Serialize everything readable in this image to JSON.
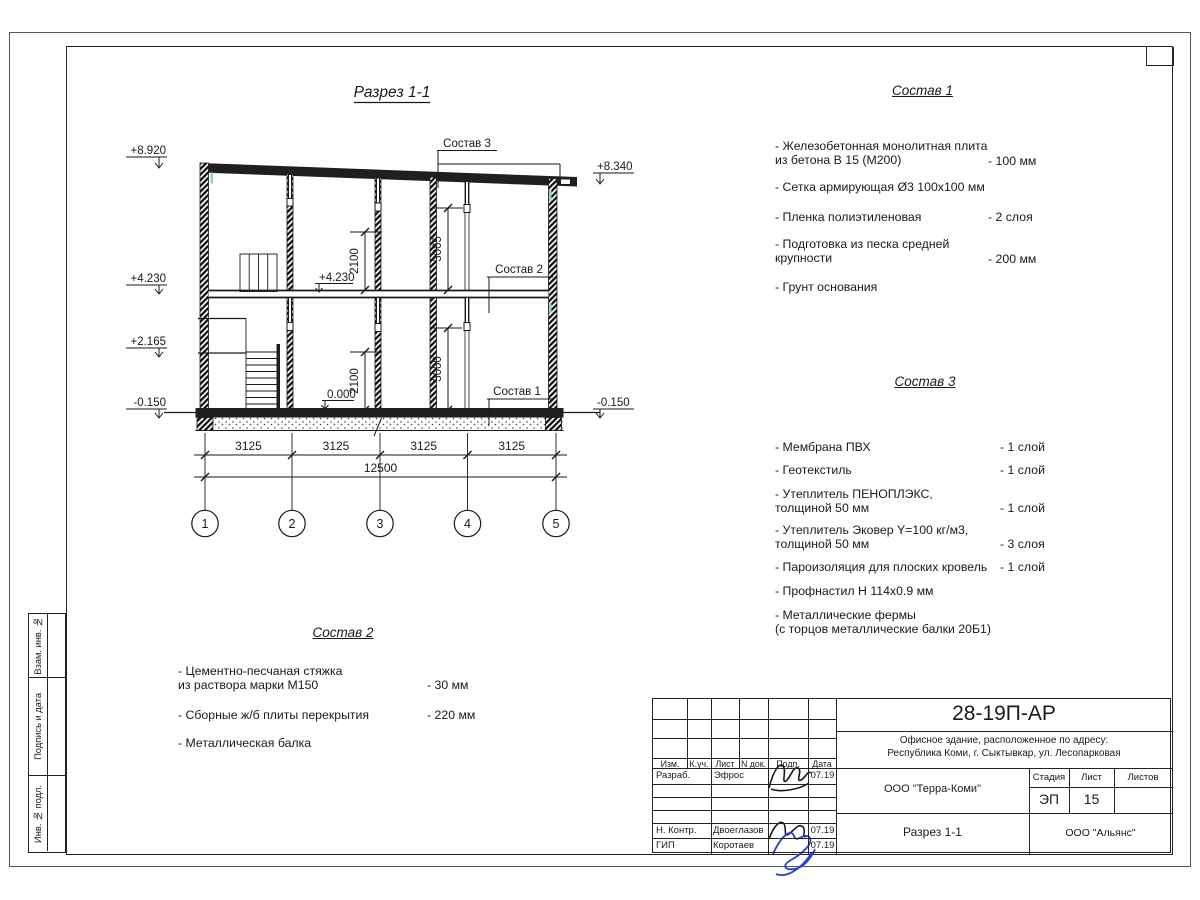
{
  "sheet": {
    "side_strip": [
      "Взам. инв. №",
      "Подпись и дата",
      "Инв. № подл."
    ]
  },
  "drawing": {
    "title": "Разрез 1-1",
    "leader_labels": {
      "sostav3": "Состав 3",
      "sostav2": "Состав 2",
      "sostav1": "Состав 1"
    },
    "elevations": {
      "left": [
        "+8.920",
        "+4.230",
        "+2.165",
        "-0.150"
      ],
      "right": [
        "+8.340",
        "-0.150"
      ],
      "inner_floor": "+4.230",
      "inner_zero": "0.000"
    },
    "vertical_dims": {
      "upper_left": "2100",
      "upper_right": "3065",
      "lower_left": "2100",
      "lower_right": "3000"
    },
    "bay_dims": [
      "3125",
      "3125",
      "3125",
      "3125"
    ],
    "total_dim": "12500",
    "axes": [
      "1",
      "2",
      "3",
      "4",
      "5"
    ]
  },
  "compositions": {
    "c1": {
      "title": "Состав 1",
      "items": [
        {
          "name": "- Железобетонная  монолитная плита\nиз бетона В 15 (М200)",
          "value": "- 100 мм"
        },
        {
          "name": "- Сетка армирующая Ø3 100х100 мм",
          "value": ""
        },
        {
          "name": "- Пленка полиэтиленовая",
          "value": "- 2 слоя"
        },
        {
          "name": "- Подготовка из песка средней\nкрупности",
          "value": "- 200 мм"
        },
        {
          "name": "- Грунт основания",
          "value": ""
        }
      ]
    },
    "c2": {
      "title": "Состав 2",
      "items": [
        {
          "name": "- Цементно-песчаная стяжка\nиз раствора марки М150",
          "value": "- 30 мм"
        },
        {
          "name": "- Сборные ж/б плиты перекрытия",
          "value": "- 220 мм"
        },
        {
          "name": "- Металлическая балка",
          "value": ""
        }
      ]
    },
    "c3": {
      "title": "Состав 3",
      "items": [
        {
          "name": "- Мембрана ПВХ",
          "value": "- 1 слой"
        },
        {
          "name": "- Геотекстиль",
          "value": "- 1 слой"
        },
        {
          "name": "- Утеплитель ПЕНОПЛЭКС,\nтолщиной 50 мм",
          "value": "- 1 слой"
        },
        {
          "name": "- Утеплитель Эковер Y=100 кг/м3,\nтолщиной 50 мм",
          "value": "- 3 слоя"
        },
        {
          "name": "- Пароизоляция для плоских кровель",
          "value": "- 1 слой"
        },
        {
          "name": "- Профнастил Н 114х0.9 мм",
          "value": ""
        },
        {
          "name": "- Металлические фермы\n(с торцов металлические балки 20Б1)",
          "value": ""
        }
      ]
    }
  },
  "title_block": {
    "code": "28-19П-АР",
    "object_address": "Офисное здание, расположенное по адресу:\nРеспублика Коми, г. Сыктывкар, ул. Лесопарковая",
    "designer_org": "ООО \"Терра-Коми\"",
    "stage_label": "Стадия",
    "sheet_label": "Лист",
    "sheets_label": "Листов",
    "stage": "ЭП",
    "sheet_no": "15",
    "sheets_total": "",
    "view_name": "Разрез 1-1",
    "client_org": "ООО \"Альянс\"",
    "columns": [
      "Изм.",
      "К.уч.",
      "Лист",
      "N док.",
      "Подп.",
      "Дата"
    ],
    "rows": [
      {
        "role": "Разраб.",
        "name": "Эфрос",
        "date": "07.19"
      },
      {
        "role": "Н. Контр.",
        "name": "Двоеглазов",
        "date": "07.19"
      },
      {
        "role": "ГИП",
        "name": "Коротаев",
        "date": "07.19"
      }
    ]
  }
}
